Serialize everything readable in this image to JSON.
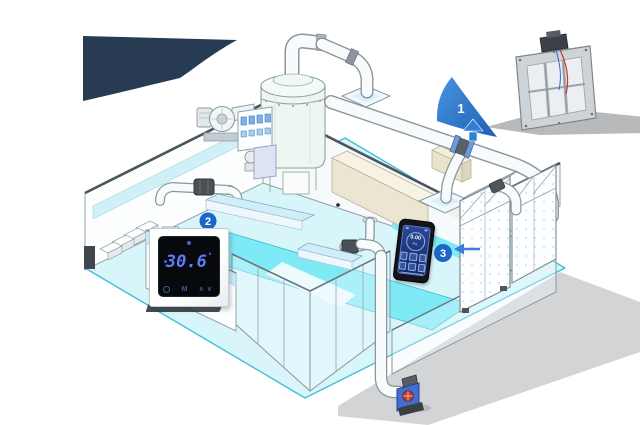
{
  "callouts": {
    "one": {
      "number": "1"
    },
    "two": {
      "number": "2"
    },
    "three": {
      "number": "3"
    },
    "accent_color": "#1b66c9"
  },
  "thermostat": {
    "temperature": "30.6",
    "degree_symbol": "°",
    "mode_button": "M",
    "up_button": "∧",
    "down_button": "∨",
    "digit_color": "#5d7dfc"
  },
  "handheld": {
    "reading": "0.00",
    "unit": "Pa",
    "screen_color": "#1d3272"
  },
  "colors": {
    "background": "#ffffff",
    "navy_wedge": "#273b52",
    "floor_cyan": "#d8f5fa",
    "floor_bright_cyan": "#7eeaf6",
    "floor_edge": "#3fc0d6",
    "wall_white": "#fdffff",
    "wall_outline": "#96a1a8",
    "glass_teal": "#c9eef6",
    "callout_blue": "#1b66c9",
    "pump_blue": "#3f6fd1",
    "pump_red": "#c23b2e",
    "beige_wall": "#ece5d2"
  }
}
